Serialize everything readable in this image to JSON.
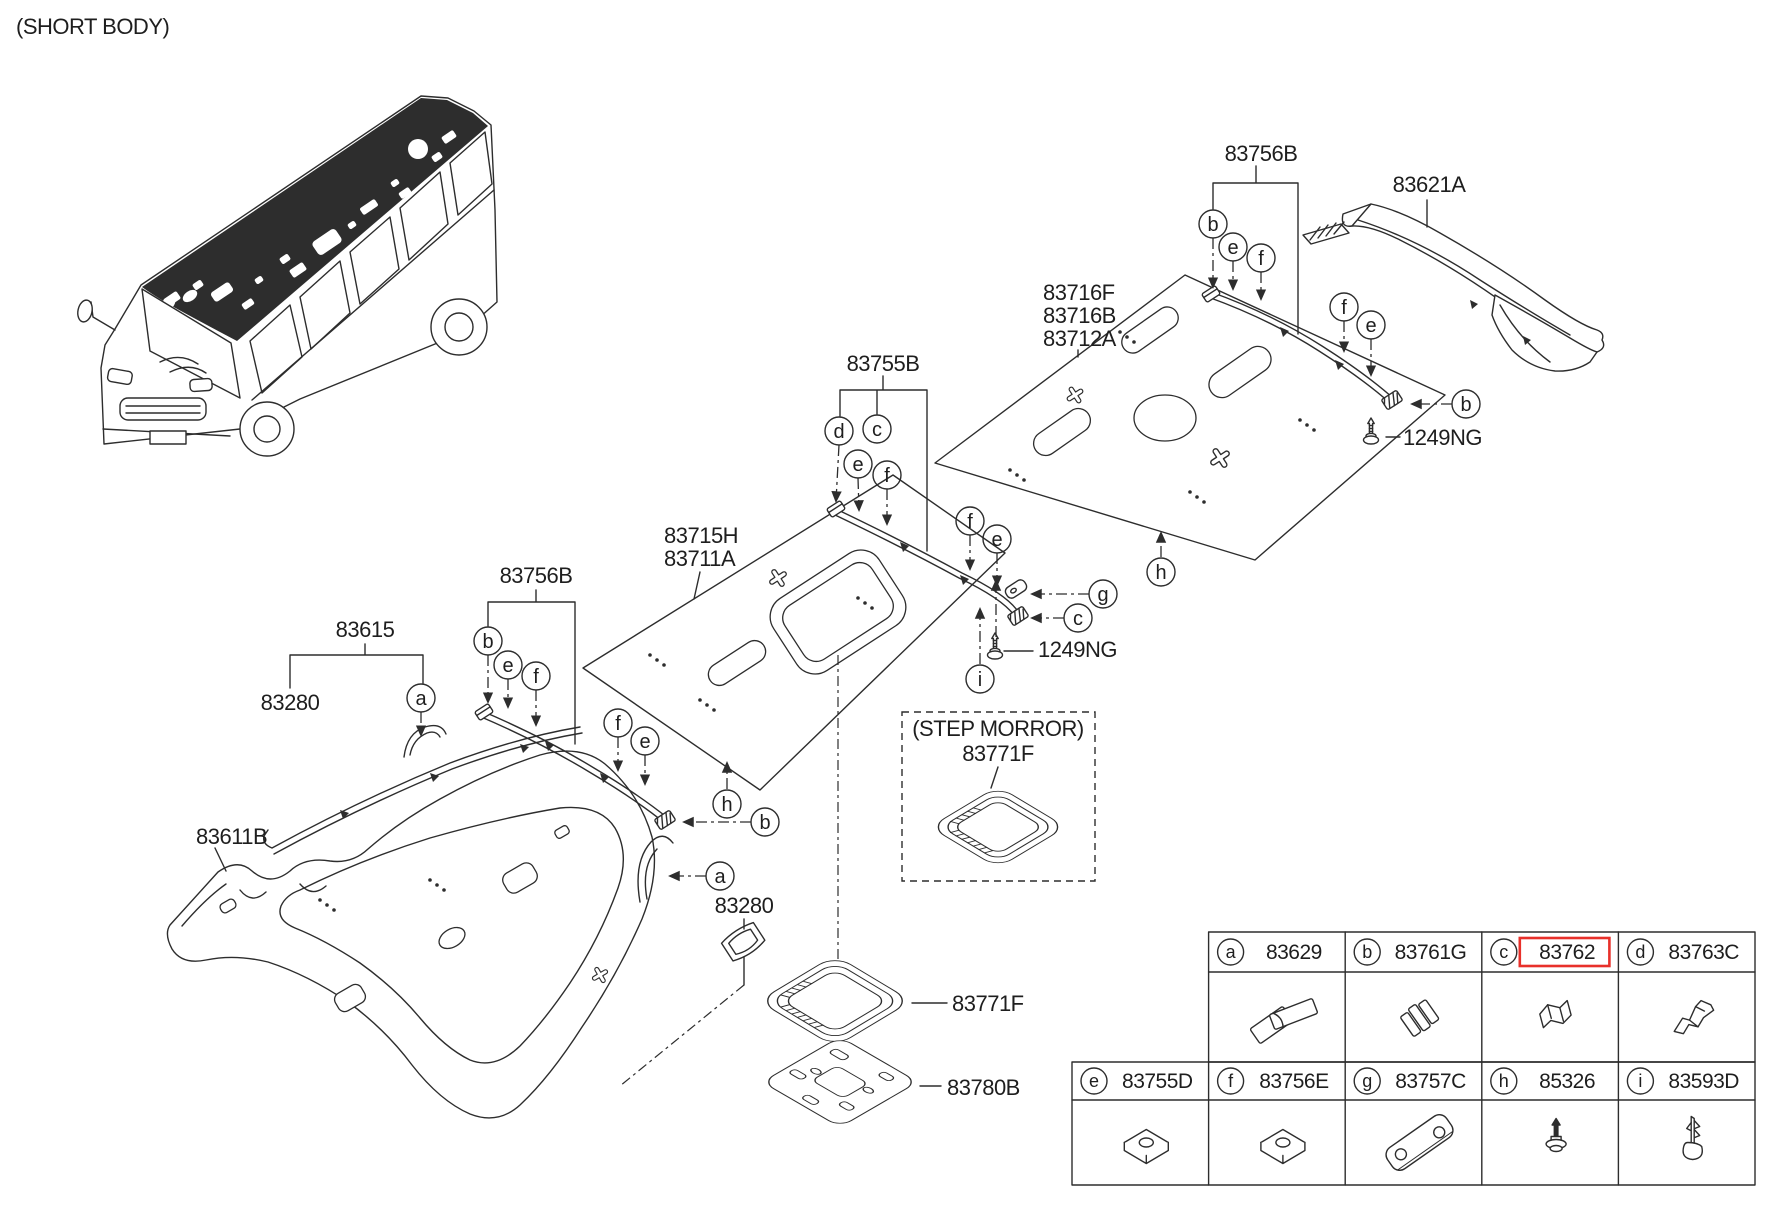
{
  "doc": {
    "variant_note": "(SHORT BODY)"
  },
  "colors": {
    "ink": "#2d2d2d",
    "highlight_red": "#e8302a",
    "paper": "#ffffff"
  },
  "part_labels": [
    {
      "id": "lbl-83756b-rear",
      "text": "83756B",
      "x": 1261,
      "y": 161,
      "anchor": "middle"
    },
    {
      "id": "lbl-83621a",
      "text": "83621A",
      "x": 1429,
      "y": 192,
      "anchor": "middle"
    },
    {
      "id": "lbl-1249ng-rear",
      "text": "1249NG",
      "x": 1403,
      "y": 445,
      "anchor": "start"
    },
    {
      "id": "lbl-83716f",
      "text": "83716F",
      "x": 1043,
      "y": 300,
      "anchor": "start"
    },
    {
      "id": "lbl-83716b",
      "text": "83716B",
      "x": 1043,
      "y": 323,
      "anchor": "start"
    },
    {
      "id": "lbl-83712a",
      "text": "83712A",
      "x": 1043,
      "y": 346,
      "anchor": "start"
    },
    {
      "id": "lbl-83755b",
      "text": "83755B",
      "x": 883,
      "y": 371,
      "anchor": "middle"
    },
    {
      "id": "lbl-83715h",
      "text": "83715H",
      "x": 664,
      "y": 543,
      "anchor": "start"
    },
    {
      "id": "lbl-83711a",
      "text": "83711A",
      "x": 664,
      "y": 566,
      "anchor": "start"
    },
    {
      "id": "lbl-83756b-front",
      "text": "83756B",
      "x": 536,
      "y": 583,
      "anchor": "middle"
    },
    {
      "id": "lbl-83615",
      "text": "83615",
      "x": 365,
      "y": 637,
      "anchor": "middle"
    },
    {
      "id": "lbl-83280-a",
      "text": "83280",
      "x": 290,
      "y": 710,
      "anchor": "middle"
    },
    {
      "id": "lbl-83611b",
      "text": "83611B",
      "x": 196,
      "y": 844,
      "anchor": "start"
    },
    {
      "id": "lbl-1249ng-mid",
      "text": "1249NG",
      "x": 1038,
      "y": 657,
      "anchor": "start"
    },
    {
      "id": "lbl-step-morror",
      "text": "(STEP MORROR)",
      "x": 998,
      "y": 736,
      "anchor": "middle"
    },
    {
      "id": "lbl-83771f-step",
      "text": "83771F",
      "x": 998,
      "y": 761,
      "anchor": "middle"
    },
    {
      "id": "lbl-83771f",
      "text": "83771F",
      "x": 952,
      "y": 1011,
      "anchor": "start"
    },
    {
      "id": "lbl-83780b",
      "text": "83780B",
      "x": 947,
      "y": 1095,
      "anchor": "start"
    },
    {
      "id": "lbl-83280-b",
      "text": "83280",
      "x": 744,
      "y": 913,
      "anchor": "middle"
    }
  ],
  "callouts": [
    {
      "letter": "b",
      "x": 1213,
      "y": 224
    },
    {
      "letter": "e",
      "x": 1233,
      "y": 247
    },
    {
      "letter": "f",
      "x": 1261,
      "y": 258
    },
    {
      "letter": "f",
      "x": 1344,
      "y": 307
    },
    {
      "letter": "e",
      "x": 1371,
      "y": 325
    },
    {
      "letter": "b",
      "x": 1466,
      "y": 404
    },
    {
      "letter": "h",
      "x": 1161,
      "y": 572
    },
    {
      "letter": "d",
      "x": 839,
      "y": 431
    },
    {
      "letter": "c",
      "x": 877,
      "y": 429
    },
    {
      "letter": "e",
      "x": 858,
      "y": 464
    },
    {
      "letter": "f",
      "x": 887,
      "y": 475
    },
    {
      "letter": "f",
      "x": 970,
      "y": 521
    },
    {
      "letter": "e",
      "x": 997,
      "y": 539
    },
    {
      "letter": "g",
      "x": 1103,
      "y": 594
    },
    {
      "letter": "c",
      "x": 1078,
      "y": 618
    },
    {
      "letter": "i",
      "x": 980,
      "y": 679
    },
    {
      "letter": "b",
      "x": 488,
      "y": 641
    },
    {
      "letter": "e",
      "x": 508,
      "y": 665
    },
    {
      "letter": "f",
      "x": 536,
      "y": 676
    },
    {
      "letter": "f",
      "x": 618,
      "y": 723
    },
    {
      "letter": "e",
      "x": 645,
      "y": 741
    },
    {
      "letter": "h",
      "x": 727,
      "y": 804
    },
    {
      "letter": "b",
      "x": 765,
      "y": 822
    },
    {
      "letter": "a",
      "x": 421,
      "y": 698
    },
    {
      "letter": "a",
      "x": 720,
      "y": 876
    }
  ],
  "callout_style": {
    "radius": 14
  },
  "ref_table": {
    "rows": [
      {
        "start_col": 1,
        "cells": [
          {
            "letter": "a",
            "part_no": "83629",
            "glyph": "grip",
            "highlight": false
          },
          {
            "letter": "b",
            "part_no": "83761G",
            "glyph": "ribbed",
            "highlight": false
          },
          {
            "letter": "c",
            "part_no": "83762",
            "glyph": "channel",
            "highlight": true
          },
          {
            "letter": "d",
            "part_no": "83763C",
            "glyph": "bracket",
            "highlight": false
          }
        ]
      },
      {
        "start_col": 0,
        "cells": [
          {
            "letter": "e",
            "part_no": "83755D",
            "glyph": "pad",
            "highlight": false
          },
          {
            "letter": "f",
            "part_no": "83756E",
            "glyph": "pad",
            "highlight": false
          },
          {
            "letter": "g",
            "part_no": "83757C",
            "glyph": "plate",
            "highlight": false
          },
          {
            "letter": "h",
            "part_no": "85326",
            "glyph": "rivet",
            "highlight": false
          },
          {
            "letter": "i",
            "part_no": "83593D",
            "glyph": "fir",
            "highlight": false
          }
        ]
      }
    ]
  }
}
